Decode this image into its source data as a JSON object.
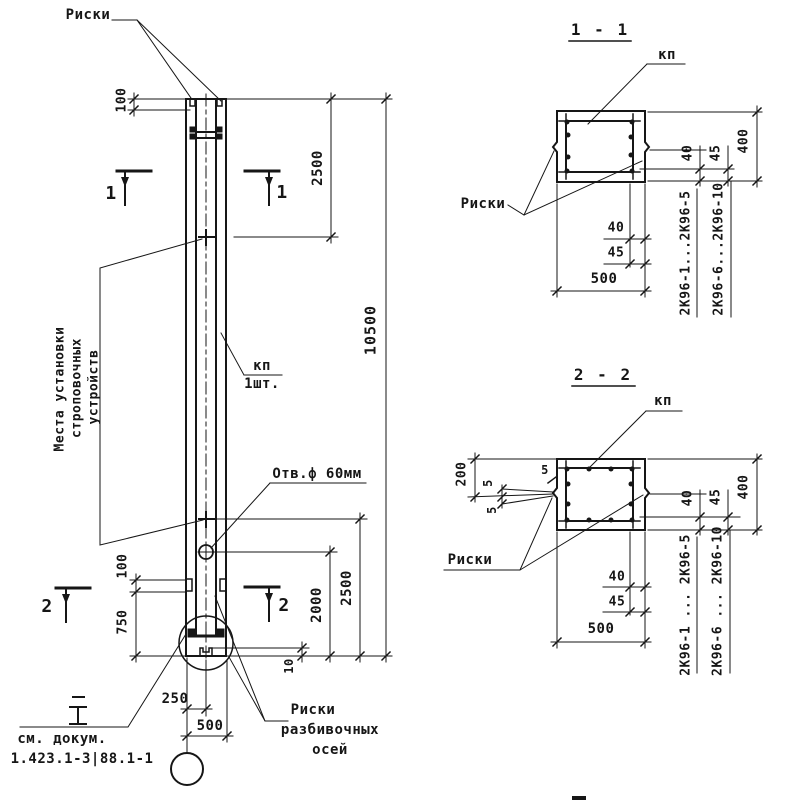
{
  "colors": {
    "ink": "#161616",
    "paper": "#ffffff"
  },
  "elevation": {
    "riski_top_label": "Риски",
    "strop_places_lines": [
      "Места установки",
      "строповочных",
      "устройств"
    ],
    "kp_label": "кп",
    "kp_qty": "1шт.",
    "hole_label": "Отв.ф 60мм",
    "axes_riski_lines": [
      "Риски",
      "разбивочных",
      "осей"
    ],
    "doc_note_lines": [
      "см. докум.",
      "1.423.1-3|88.1-1"
    ],
    "marks": {
      "s1": "1",
      "s2": "2"
    },
    "dims": {
      "top_riska_offset": "100",
      "upper_strop": "2500",
      "total_height": "10500",
      "lower_strop": "2500",
      "hole_level": "2000",
      "recess_depth": "10",
      "base_riska_offset": "100",
      "base_strop": "750",
      "axis_offset": "250",
      "width": "500"
    }
  },
  "section_1": {
    "title": "1 - 1",
    "kp_label": "кп",
    "riski_label": "Риски",
    "dims": {
      "cover_a": "40",
      "cover_b": "45",
      "side_a": "40",
      "side_b": "45",
      "width": "500",
      "height": "400"
    },
    "series_a": "2К96-1...2К96-5",
    "series_b": "2К96-6...2К96-10"
  },
  "section_2": {
    "title": "2 - 2",
    "kp_label": "кп",
    "riski_label": "Риски",
    "dims": {
      "top_offset": "200",
      "gap_a": "5",
      "gap_b": "5",
      "gap_c": "5",
      "cover_a": "40",
      "cover_b": "45",
      "side_a": "40",
      "side_b": "45",
      "width": "500",
      "height": "400"
    },
    "series_a": "2К96-1 ... 2К96-5",
    "series_b": "2К96-6 ... 2К96-10"
  }
}
